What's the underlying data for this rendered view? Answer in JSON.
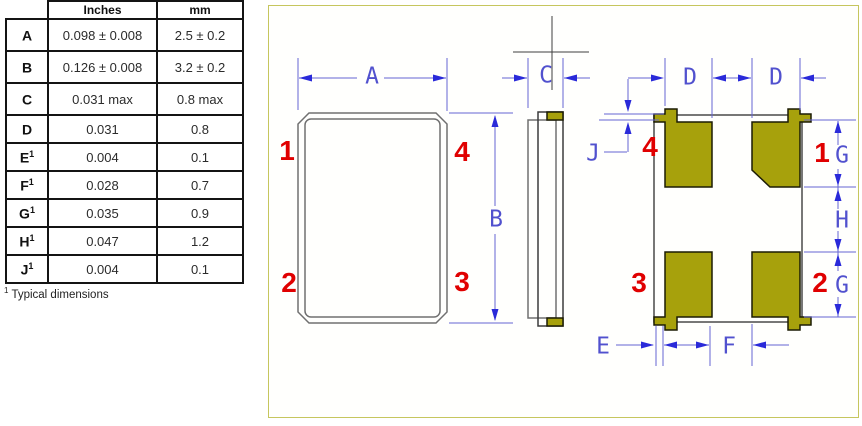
{
  "table": {
    "headers": {
      "label": "",
      "inches": "Inches",
      "mm": "mm"
    },
    "rows": [
      {
        "label": "A",
        "sup": "",
        "inches": "0.098 ± 0.008",
        "mm": "2.5 ± 0.2"
      },
      {
        "label": "B",
        "sup": "",
        "inches": "0.126 ± 0.008",
        "mm": "3.2 ± 0.2"
      },
      {
        "label": "C",
        "sup": "",
        "inches": "0.031 max",
        "mm": "0.8 max"
      },
      {
        "label": "D",
        "sup": "",
        "inches": "0.031",
        "mm": "0.8"
      },
      {
        "label": "E",
        "sup": "1",
        "inches": "0.004",
        "mm": "0.1"
      },
      {
        "label": "F",
        "sup": "1",
        "inches": "0.028",
        "mm": "0.7"
      },
      {
        "label": "G",
        "sup": "1",
        "inches": "0.035",
        "mm": "0.9"
      },
      {
        "label": "H",
        "sup": "1",
        "inches": "0.047",
        "mm": "1.2"
      },
      {
        "label": "J",
        "sup": "1",
        "inches": "0.004",
        "mm": "0.1"
      }
    ],
    "footnote_sup": "1",
    "footnote": " Typical dimensions"
  },
  "drawing": {
    "dim_labels": {
      "A": "A",
      "B": "B",
      "C": "C",
      "D": "D",
      "E": "E",
      "F": "F",
      "G": "G",
      "H": "H",
      "J": "J"
    },
    "top_view_pins": {
      "tl": "1",
      "tr": "4",
      "bl": "2",
      "br": "3"
    },
    "bottom_view_pins": {
      "tl": "4",
      "tr": "1",
      "bl": "3",
      "br": "2"
    },
    "colors": {
      "dimension_blue": "#5151ce",
      "pad_olive": "#a7a10c",
      "pin_red": "#e00000",
      "panel_border": "#c6c65e"
    }
  }
}
